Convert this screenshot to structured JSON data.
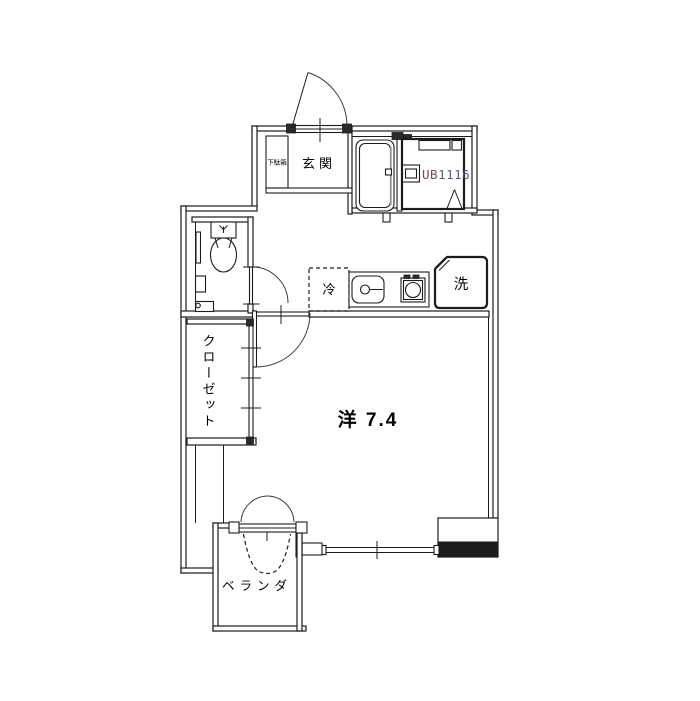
{
  "plan_title": "apartment-floor-plan",
  "rooms": {
    "entrance": {
      "label": "玄関",
      "shoe_cabinet": "下駄箱"
    },
    "unit_bath": {
      "prefix": "UB",
      "size": "1116"
    },
    "kitchen": {
      "refrigerator": "冷",
      "washer": "洗"
    },
    "closet": {
      "label": "クローゼット"
    },
    "main": {
      "label": "洋 7.4",
      "type": "洋",
      "area_tatami": "7.4"
    },
    "balcony": {
      "label": "ベランダ"
    }
  },
  "colors": {
    "line": "#1c1c1c",
    "ub_prefix": "#7a4848",
    "ub_number": "#4c5a85",
    "balcony_text": "#5f6e88",
    "room_text": "#000000"
  }
}
